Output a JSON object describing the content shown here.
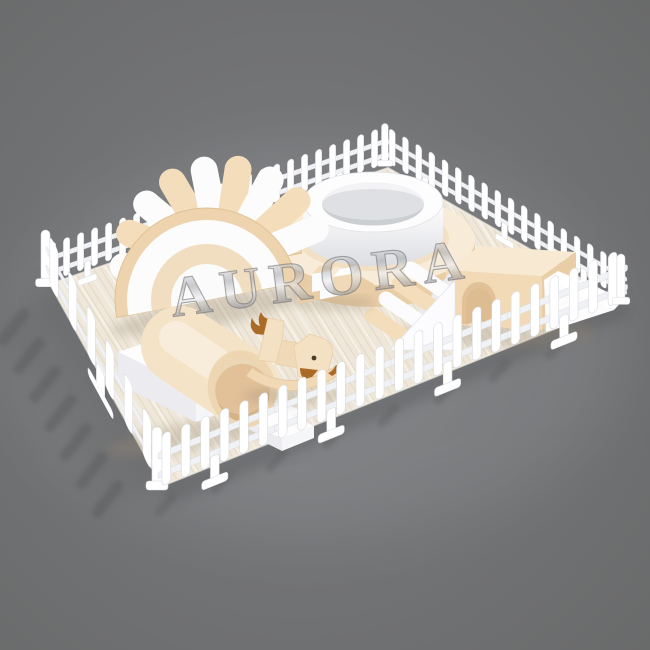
{
  "meta": {
    "type": "3d-product-render",
    "subject": "Indoor toddler soft play set enclosed by a white picket fence on a cream wood-grain mat",
    "background_style": "neutral gray studio backdrop"
  },
  "watermark": {
    "text": "AURORA",
    "style": "chrome-3d-serif"
  },
  "palette": {
    "background": "#6e6f70",
    "background_light": "#8d8e91",
    "floor_shadow": "#58595b",
    "mat_base": "#eee7da",
    "mat_grain": "#dcc9ae",
    "fence_white": "#ffffff",
    "fence_shade": "#d9dade",
    "soft_white": "#fcfcfd",
    "soft_white_shade": "#ececf0",
    "cream": "#f2dab6",
    "cream_light": "#f8ecd9",
    "cream_deep": "#e2c199",
    "brown_accent": "#ab6b28",
    "watermark_silver": "#c9c9cc"
  },
  "equipment": [
    {
      "id": "picket-fence",
      "label": "white picket fence enclosure"
    },
    {
      "id": "play-mat",
      "label": "cream wood-grain padded mat"
    },
    {
      "id": "rainbow-roller-bridge",
      "label": "rainbow arch climber with soft rollers"
    },
    {
      "id": "ball-pit",
      "label": "round two-tier ball pit"
    },
    {
      "id": "tunnel-step-climber",
      "label": "tunnel climber with steps"
    },
    {
      "id": "roller-ramp-house",
      "label": "arch house with roller ramp and slide wedge"
    },
    {
      "id": "soft-blocks",
      "label": "stacking soft blocks"
    },
    {
      "id": "rocking-horse",
      "label": "soft rocking horse"
    }
  ]
}
